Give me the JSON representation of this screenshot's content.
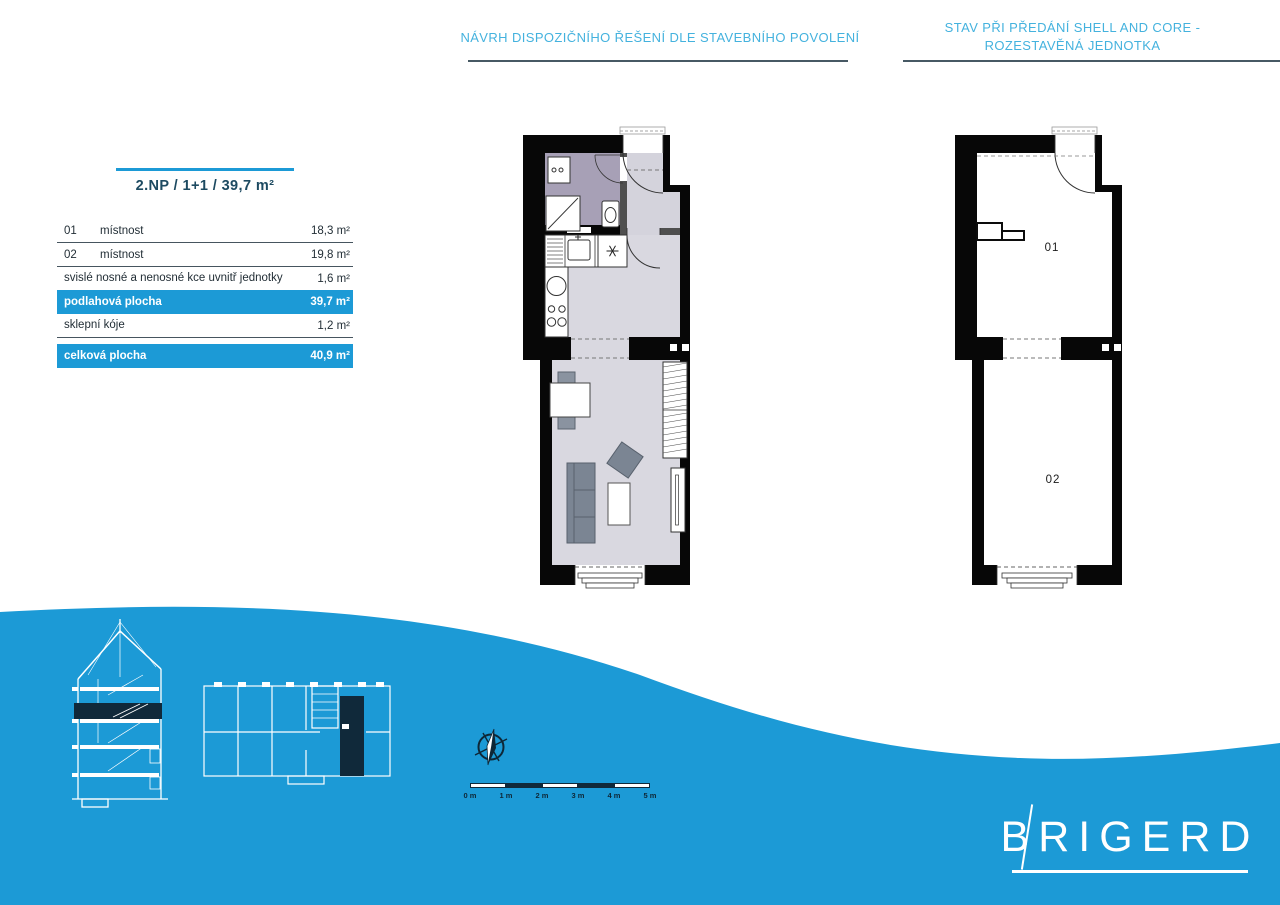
{
  "page": {
    "header_left": "NÁVRH DISPOZIČNÍHO ŘEŠENÍ DLE STAVEBNÍHO POVOLENÍ",
    "header_right_line1": "STAV PŘI PŘEDÁNÍ SHELL AND CORE -",
    "header_right_line2": "ROZESTAVĚNÁ JEDNOTKA"
  },
  "unit_table": {
    "title": "2.NP / 1+1 / 39,7 m²",
    "rows": [
      {
        "code": "01",
        "label": "místnost",
        "value": "18,3 m²"
      },
      {
        "code": "02",
        "label": "místnost",
        "value": "19,8 m²"
      },
      {
        "code": "",
        "label": "svislé nosné a nenosné kce uvnitř jednotky",
        "value": "1,6 m²"
      },
      {
        "code": "",
        "label": "podlahová plocha",
        "value": "39,7 m²"
      },
      {
        "code": "",
        "label": "sklepní kóje",
        "value": "1,2 m²"
      },
      {
        "code": "",
        "label": "celková plocha",
        "value": "40,9 m²"
      }
    ]
  },
  "plans": {
    "shell_room1_label": "01",
    "shell_room2_label": "02"
  },
  "scale_bar": {
    "labels": [
      "0 m",
      "1 m",
      "2 m",
      "3 m",
      "4 m",
      "5 m"
    ]
  },
  "logo": {
    "text": "BRIGERD"
  },
  "colors": {
    "accent_blue": "#1c9ad6",
    "dark_navy": "#10293a",
    "header_text": "#44b2de",
    "table_title": "#1d4a61",
    "bathroom_floor": "#a7a0b6",
    "room_floor": "#d9d8e0",
    "furniture_gray": "#7b8593"
  }
}
